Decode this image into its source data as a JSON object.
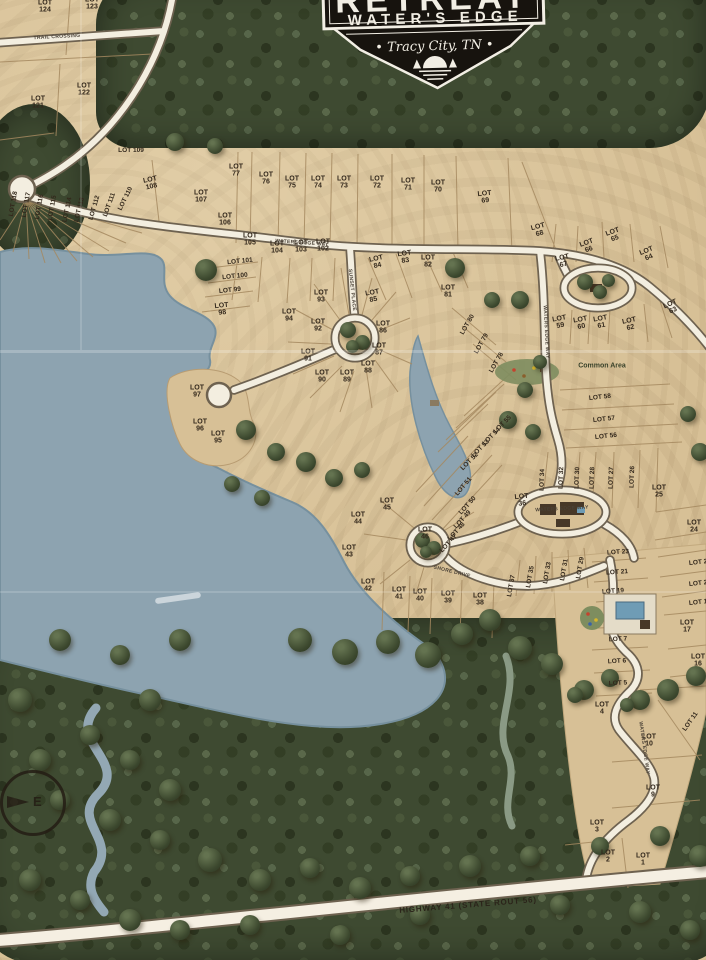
{
  "badge": {
    "retreat": "RETREAT",
    "waters_edge": "WATER'S EDGE",
    "location": "• Tracy City, TN •"
  },
  "compass": {
    "label": "E"
  },
  "areas": [
    {
      "t": "Common Area",
      "x": 602,
      "y": 366,
      "r": 0
    }
  ],
  "streets": [
    {
      "t": "TRAIL CROSSING",
      "x": 57,
      "y": 37,
      "r": -3,
      "size": 5
    },
    {
      "t": "WATERS EDGE WAY",
      "x": 302,
      "y": 243,
      "r": 4,
      "size": 5
    },
    {
      "t": "SUNSET PLACE",
      "x": 352,
      "y": 290,
      "r": 84,
      "size": 5
    },
    {
      "t": "WATERS EDGE WAY",
      "x": 546,
      "y": 332,
      "r": 87,
      "size": 5
    },
    {
      "t": "WATERS EDGE WAY",
      "x": 562,
      "y": 509,
      "r": -3,
      "size": 5
    },
    {
      "t": "SHORE DRIVE",
      "x": 452,
      "y": 572,
      "r": 14,
      "size": 5
    },
    {
      "t": "WATERS EDGE WAY",
      "x": 644,
      "y": 748,
      "r": 82,
      "size": 5
    },
    {
      "t": "HIGHWAY 41 (STATE ROUT 56)",
      "x": 468,
      "y": 905,
      "r": -4.5,
      "size": 8,
      "hwy": true
    }
  ],
  "lots": [
    {
      "t": "LOT 124",
      "x": 45,
      "y": 7,
      "r": 0,
      "s": 1
    },
    {
      "t": "LOT 123",
      "x": 92,
      "y": 4,
      "r": 0,
      "s": 1
    },
    {
      "t": "LOT 122",
      "x": 84,
      "y": 90,
      "r": 0,
      "s": 1
    },
    {
      "t": "LOT 121",
      "x": 38,
      "y": 103,
      "r": 0,
      "s": 1
    },
    {
      "t": "LOT 109",
      "x": 131,
      "y": 151,
      "r": 0,
      "s": 0
    },
    {
      "t": "LOT 118",
      "x": 14,
      "y": 204,
      "r": -80,
      "s": 0
    },
    {
      "t": "LOT 117",
      "x": 27,
      "y": 205,
      "r": -80,
      "s": 0
    },
    {
      "t": "LOT 116",
      "x": 40,
      "y": 207,
      "r": -80,
      "s": 0
    },
    {
      "t": "LOT 115",
      "x": 53,
      "y": 208,
      "r": -80,
      "s": 0
    },
    {
      "t": "LOT 114",
      "x": 68,
      "y": 210,
      "r": -78,
      "s": 0
    },
    {
      "t": "LOT 113",
      "x": 80,
      "y": 210,
      "r": -76,
      "s": 0
    },
    {
      "t": "LOT 112",
      "x": 95,
      "y": 208,
      "r": -74,
      "s": 0
    },
    {
      "t": "LOT 111",
      "x": 110,
      "y": 205,
      "r": -70,
      "s": 0
    },
    {
      "t": "LOT 110",
      "x": 126,
      "y": 199,
      "r": -64,
      "s": 0
    },
    {
      "t": "LOT 108",
      "x": 151,
      "y": 184,
      "r": -12,
      "s": 1
    },
    {
      "t": "LOT 107",
      "x": 201,
      "y": 197,
      "r": 0,
      "s": 1
    },
    {
      "t": "LOT 106",
      "x": 225,
      "y": 220,
      "r": 0,
      "s": 1
    },
    {
      "t": "LOT 105",
      "x": 250,
      "y": 240,
      "r": 0,
      "s": 1
    },
    {
      "t": "LOT 104",
      "x": 277,
      "y": 248,
      "r": 0,
      "s": 1
    },
    {
      "t": "LOT 103",
      "x": 301,
      "y": 247,
      "r": 0,
      "s": 1
    },
    {
      "t": "LOT 102",
      "x": 323,
      "y": 246,
      "r": 0,
      "s": 1
    },
    {
      "t": "LOT 101",
      "x": 240,
      "y": 262,
      "r": -6,
      "s": 0
    },
    {
      "t": "LOT 100",
      "x": 235,
      "y": 277,
      "r": -6,
      "s": 0
    },
    {
      "t": "LOT 99",
      "x": 230,
      "y": 291,
      "r": -6,
      "s": 0
    },
    {
      "t": "LOT 98",
      "x": 222,
      "y": 310,
      "r": -6,
      "s": 1
    },
    {
      "t": "LOT 77",
      "x": 236,
      "y": 171,
      "r": 0,
      "s": 1
    },
    {
      "t": "LOT 76",
      "x": 266,
      "y": 179,
      "r": 0,
      "s": 1
    },
    {
      "t": "LOT 75",
      "x": 292,
      "y": 183,
      "r": 0,
      "s": 1
    },
    {
      "t": "LOT 74",
      "x": 318,
      "y": 183,
      "r": 0,
      "s": 1
    },
    {
      "t": "LOT 73",
      "x": 344,
      "y": 183,
      "r": 0,
      "s": 1
    },
    {
      "t": "LOT 72",
      "x": 377,
      "y": 183,
      "r": 0,
      "s": 1
    },
    {
      "t": "LOT 71",
      "x": 408,
      "y": 185,
      "r": 0,
      "s": 1
    },
    {
      "t": "LOT 70",
      "x": 438,
      "y": 187,
      "r": 0,
      "s": 1
    },
    {
      "t": "LOT 69",
      "x": 485,
      "y": 198,
      "r": -6,
      "s": 1
    },
    {
      "t": "LOT 68",
      "x": 539,
      "y": 231,
      "r": -15,
      "s": 1
    },
    {
      "t": "LOT 67",
      "x": 563,
      "y": 262,
      "r": -12,
      "s": 1
    },
    {
      "t": "LOT 66",
      "x": 588,
      "y": 247,
      "r": -20,
      "s": 1
    },
    {
      "t": "LOT 65",
      "x": 614,
      "y": 236,
      "r": -20,
      "s": 1
    },
    {
      "t": "LOT 64",
      "x": 648,
      "y": 255,
      "r": -22,
      "s": 1
    },
    {
      "t": "LOT 63",
      "x": 672,
      "y": 308,
      "r": -25,
      "s": 1
    },
    {
      "t": "LOT 62",
      "x": 630,
      "y": 325,
      "r": -12,
      "s": 1
    },
    {
      "t": "LOT 61",
      "x": 601,
      "y": 323,
      "r": -10,
      "s": 1
    },
    {
      "t": "LOT 60",
      "x": 581,
      "y": 324,
      "r": -10,
      "s": 1
    },
    {
      "t": "LOT 59",
      "x": 560,
      "y": 323,
      "r": -10,
      "s": 1
    },
    {
      "t": "LOT 94",
      "x": 289,
      "y": 316,
      "r": 0,
      "s": 1
    },
    {
      "t": "LOT 93",
      "x": 321,
      "y": 297,
      "r": 0,
      "s": 1
    },
    {
      "t": "LOT 92",
      "x": 318,
      "y": 326,
      "r": 0,
      "s": 1
    },
    {
      "t": "LOT 91",
      "x": 308,
      "y": 356,
      "r": 0,
      "s": 1
    },
    {
      "t": "LOT 90",
      "x": 322,
      "y": 377,
      "r": 0,
      "s": 1
    },
    {
      "t": "LOT 89",
      "x": 347,
      "y": 377,
      "r": 0,
      "s": 1
    },
    {
      "t": "LOT 88",
      "x": 368,
      "y": 368,
      "r": 0,
      "s": 1
    },
    {
      "t": "LOT 87",
      "x": 379,
      "y": 350,
      "r": 0,
      "s": 1
    },
    {
      "t": "LOT 86",
      "x": 383,
      "y": 328,
      "r": 0,
      "s": 1
    },
    {
      "t": "LOT 85",
      "x": 373,
      "y": 297,
      "r": -10,
      "s": 1
    },
    {
      "t": "LOT 84",
      "x": 377,
      "y": 263,
      "r": -12,
      "s": 1
    },
    {
      "t": "LOT 83",
      "x": 405,
      "y": 258,
      "r": -8,
      "s": 1
    },
    {
      "t": "LOT 82",
      "x": 428,
      "y": 262,
      "r": 0,
      "s": 1
    },
    {
      "t": "LOT 81",
      "x": 448,
      "y": 292,
      "r": 0,
      "s": 1
    },
    {
      "t": "LOT 80",
      "x": 468,
      "y": 325,
      "r": -60,
      "s": 0
    },
    {
      "t": "LOT 79",
      "x": 482,
      "y": 344,
      "r": -60,
      "s": 0
    },
    {
      "t": "LOT 78",
      "x": 497,
      "y": 363,
      "r": -60,
      "s": 0
    },
    {
      "t": "LOT 97",
      "x": 197,
      "y": 392,
      "r": 0,
      "s": 1
    },
    {
      "t": "LOT 96",
      "x": 200,
      "y": 426,
      "r": 0,
      "s": 1
    },
    {
      "t": "LOT 95",
      "x": 218,
      "y": 438,
      "r": 0,
      "s": 1
    },
    {
      "t": "LOT 58",
      "x": 600,
      "y": 398,
      "r": -6,
      "s": 0
    },
    {
      "t": "LOT 57",
      "x": 604,
      "y": 420,
      "r": -6,
      "s": 0
    },
    {
      "t": "LOT 56",
      "x": 606,
      "y": 437,
      "r": -6,
      "s": 0
    },
    {
      "t": "LOT 55",
      "x": 503,
      "y": 425,
      "r": -45,
      "s": 0
    },
    {
      "t": "LOT 54",
      "x": 492,
      "y": 437,
      "r": -45,
      "s": 0
    },
    {
      "t": "LOT 53",
      "x": 481,
      "y": 449,
      "r": -45,
      "s": 0
    },
    {
      "t": "LOT 52",
      "x": 470,
      "y": 462,
      "r": -45,
      "s": 0
    },
    {
      "t": "LOT 51",
      "x": 464,
      "y": 487,
      "r": -50,
      "s": 0
    },
    {
      "t": "LOT 50",
      "x": 468,
      "y": 506,
      "r": -48,
      "s": 0
    },
    {
      "t": "LOT 49",
      "x": 463,
      "y": 520,
      "r": -48,
      "s": 0
    },
    {
      "t": "LOT 48",
      "x": 457,
      "y": 532,
      "r": -48,
      "s": 0
    },
    {
      "t": "LOT 47",
      "x": 449,
      "y": 544,
      "r": -48,
      "s": 0
    },
    {
      "t": "LOT 46",
      "x": 425,
      "y": 534,
      "r": 0,
      "s": 1
    },
    {
      "t": "LOT 45",
      "x": 387,
      "y": 505,
      "r": 0,
      "s": 1
    },
    {
      "t": "LOT 44",
      "x": 358,
      "y": 519,
      "r": 0,
      "s": 1
    },
    {
      "t": "LOT 43",
      "x": 349,
      "y": 552,
      "r": 0,
      "s": 1
    },
    {
      "t": "LOT 42",
      "x": 368,
      "y": 586,
      "r": 0,
      "s": 1
    },
    {
      "t": "LOT 41",
      "x": 399,
      "y": 594,
      "r": 0,
      "s": 1
    },
    {
      "t": "LOT 40",
      "x": 420,
      "y": 596,
      "r": 0,
      "s": 1
    },
    {
      "t": "LOT 39",
      "x": 448,
      "y": 598,
      "r": 0,
      "s": 1
    },
    {
      "t": "LOT 38",
      "x": 480,
      "y": 600,
      "r": 0,
      "s": 1
    },
    {
      "t": "LOT 37",
      "x": 512,
      "y": 586,
      "r": -80,
      "s": 0
    },
    {
      "t": "LOT 36",
      "x": 522,
      "y": 501,
      "r": -6,
      "s": 1
    },
    {
      "t": "LOT 35",
      "x": 531,
      "y": 577,
      "r": -80,
      "s": 0
    },
    {
      "t": "LOT 34",
      "x": 543,
      "y": 480,
      "r": -88,
      "s": 0
    },
    {
      "t": "LOT 33",
      "x": 548,
      "y": 573,
      "r": -80,
      "s": 0
    },
    {
      "t": "LOT 32",
      "x": 562,
      "y": 478,
      "r": -88,
      "s": 0
    },
    {
      "t": "LOT 31",
      "x": 565,
      "y": 570,
      "r": -80,
      "s": 0
    },
    {
      "t": "LOT 30",
      "x": 578,
      "y": 478,
      "r": -88,
      "s": 0
    },
    {
      "t": "LOT 29",
      "x": 581,
      "y": 568,
      "r": -80,
      "s": 0
    },
    {
      "t": "LOT 28",
      "x": 593,
      "y": 478,
      "r": -88,
      "s": 0
    },
    {
      "t": "LOT 27",
      "x": 612,
      "y": 478,
      "r": -88,
      "s": 0
    },
    {
      "t": "LOT 26",
      "x": 633,
      "y": 477,
      "r": -88,
      "s": 0
    },
    {
      "t": "LOT 25",
      "x": 659,
      "y": 492,
      "r": 0,
      "s": 1
    },
    {
      "t": "LOT 24",
      "x": 694,
      "y": 527,
      "r": 0,
      "s": 1
    },
    {
      "t": "LOT 23",
      "x": 618,
      "y": 553,
      "r": -4,
      "s": 0
    },
    {
      "t": "LOT 22",
      "x": 700,
      "y": 563,
      "r": -6,
      "s": 0
    },
    {
      "t": "LOT 21",
      "x": 617,
      "y": 573,
      "r": -4,
      "s": 0
    },
    {
      "t": "LOT 20",
      "x": 700,
      "y": 584,
      "r": -6,
      "s": 0
    },
    {
      "t": "LOT 19",
      "x": 613,
      "y": 592,
      "r": -4,
      "s": 0
    },
    {
      "t": "LOT 18",
      "x": 700,
      "y": 603,
      "r": -6,
      "s": 0
    },
    {
      "t": "LOT 17",
      "x": 687,
      "y": 627,
      "r": 0,
      "s": 1
    },
    {
      "t": "LOT 16",
      "x": 698,
      "y": 661,
      "r": 0,
      "s": 1
    },
    {
      "t": "LOT 7",
      "x": 618,
      "y": 640,
      "r": -3,
      "s": 0
    },
    {
      "t": "LOT 6",
      "x": 617,
      "y": 662,
      "r": -3,
      "s": 0
    },
    {
      "t": "LOT 5",
      "x": 618,
      "y": 684,
      "r": -3,
      "s": 0
    },
    {
      "t": "LOT 4",
      "x": 602,
      "y": 709,
      "r": 0,
      "s": 1
    },
    {
      "t": "LOT 11",
      "x": 691,
      "y": 722,
      "r": -55,
      "s": 0
    },
    {
      "t": "LOT 10",
      "x": 649,
      "y": 741,
      "r": 0,
      "s": 1
    },
    {
      "t": "LOT 9",
      "x": 653,
      "y": 792,
      "r": 0,
      "s": 1
    },
    {
      "t": "LOT 3",
      "x": 597,
      "y": 827,
      "r": 0,
      "s": 1
    },
    {
      "t": "LOT 2",
      "x": 608,
      "y": 857,
      "r": 0,
      "s": 1
    },
    {
      "t": "LOT 1",
      "x": 643,
      "y": 860,
      "r": 0,
      "s": 1
    }
  ]
}
